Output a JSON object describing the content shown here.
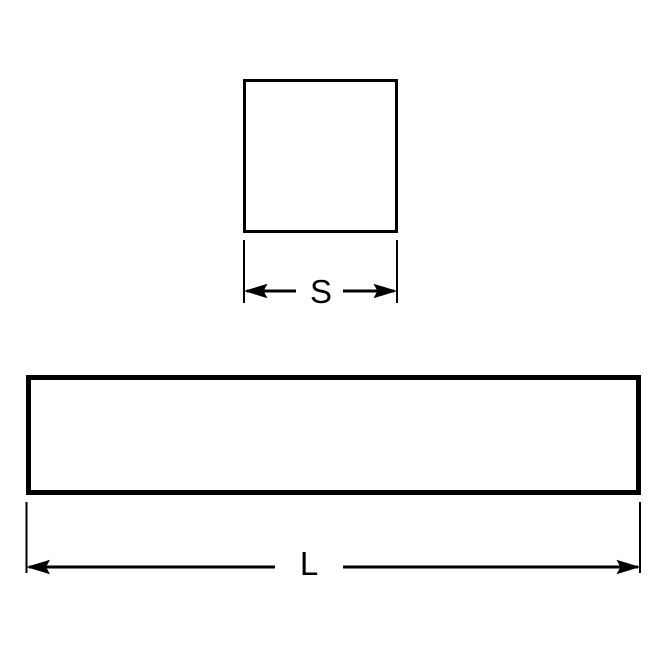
{
  "diagram": {
    "square_view": {
      "dimension_label": "S"
    },
    "length_view": {
      "dimension_label": "L"
    },
    "colors": {
      "line": "#000000",
      "background": "#ffffff"
    }
  }
}
